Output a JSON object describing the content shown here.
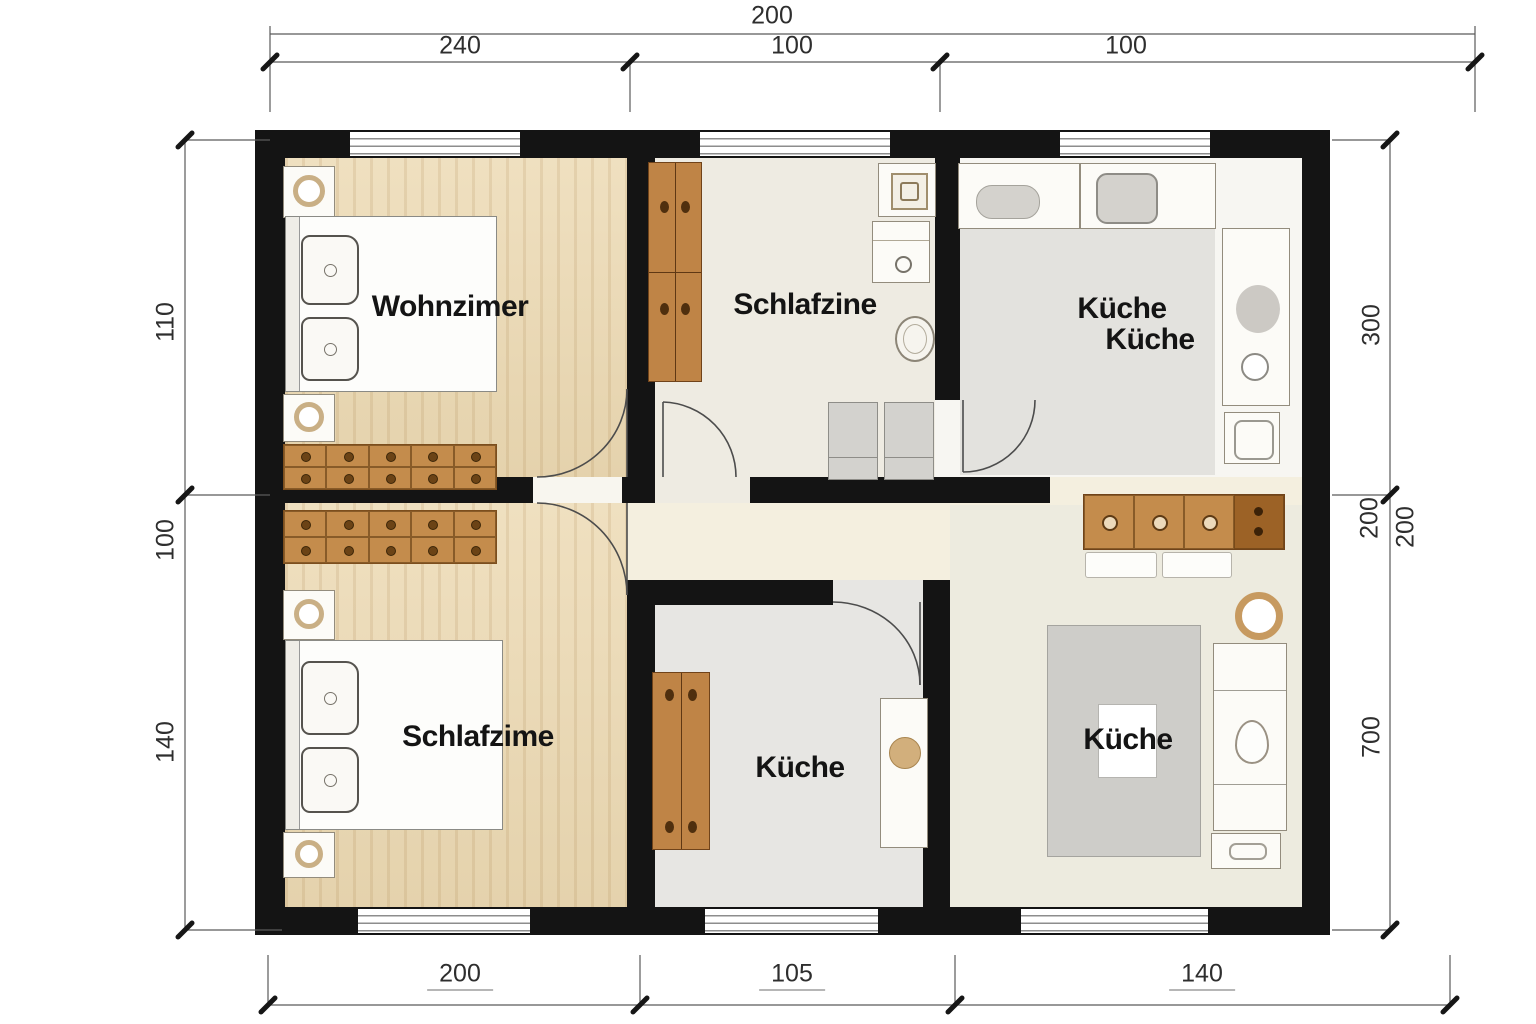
{
  "plan": {
    "type": "apartment floor plan",
    "rooms": {
      "wohnzimmer": {
        "label": "Wohnzimer"
      },
      "schlafzimmer_top": {
        "label": "Schlafzine"
      },
      "kueche_topright": {
        "label_line1": "Küche",
        "label_line2": "Küche"
      },
      "schlafzimmer_bottom": {
        "label": "Schlafzime"
      },
      "kueche_mid": {
        "label": "Küche"
      },
      "kueche_bottomright": {
        "label": "Küche"
      }
    },
    "dimensions": {
      "top_overall": "200",
      "top_segments": [
        "240",
        "100",
        "100"
      ],
      "bottom_segments": [
        "200",
        "105",
        "140"
      ],
      "left_segments": [
        "110",
        "100",
        "140"
      ],
      "right_segments": [
        "300",
        "200",
        "200",
        "700"
      ]
    },
    "colors": {
      "wall": "#141414",
      "wood_floor": "#ecd9b2",
      "wood_furniture": "#c48c4c",
      "corridor_floor": "#f4efdf",
      "gray_floor": "#e3e2de",
      "dimension_text": "#2e2e2e"
    }
  }
}
